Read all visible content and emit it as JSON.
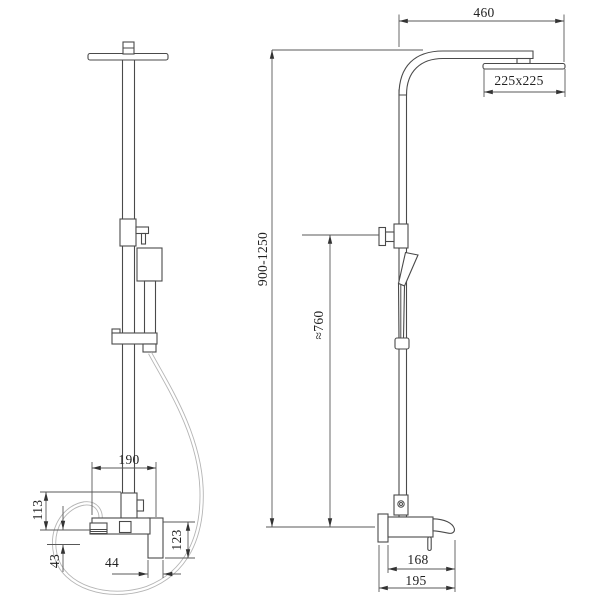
{
  "drawing": {
    "title": "Shower column technical drawing, front and side views",
    "line_color": "#4a4a4a",
    "dimension_color": "#585858",
    "dimensions": {
      "arm_reach": "460",
      "head_size": "225x225",
      "total_height": "900-1250",
      "hand_shower_height": "≈760",
      "mixer_width": "190",
      "mixer_upper_offset": "113",
      "mixer_lower_offset": "43",
      "spout_width_front": "44",
      "spout_drop": "123",
      "spout_reach": "168",
      "total_reach": "195"
    }
  }
}
